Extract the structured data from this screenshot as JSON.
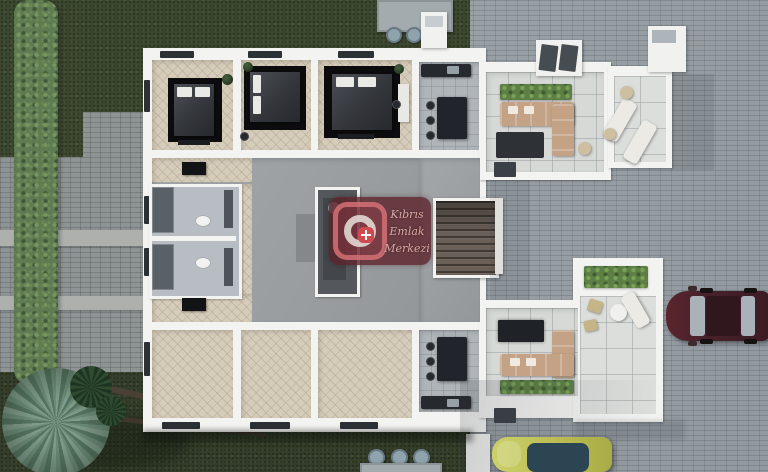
{
  "watermark": {
    "line1": "Kıbrıs",
    "line2": "Emlak",
    "line3": "Merkezi",
    "background_color": "#5c232c",
    "emblem_color": "#cf4a50",
    "text_color": "#d6aca7"
  },
  "palette": {
    "grass": "#3d4830",
    "hedge": "#5e7b52",
    "pavement": "#99a1a7",
    "wall_white": "#f3f3f1",
    "wood_floor": "#d6ccba",
    "concrete_floor": "#9da1a4",
    "terrace_tile": "#d9dbd9",
    "bed": "#3a3e44",
    "rug": "#0c0c0e",
    "sofa": "#c3a285",
    "plants": "#5d7f46",
    "stairs": "#6a6058",
    "car_maroon": "#46242c",
    "car_yellow": "#bfc158"
  }
}
